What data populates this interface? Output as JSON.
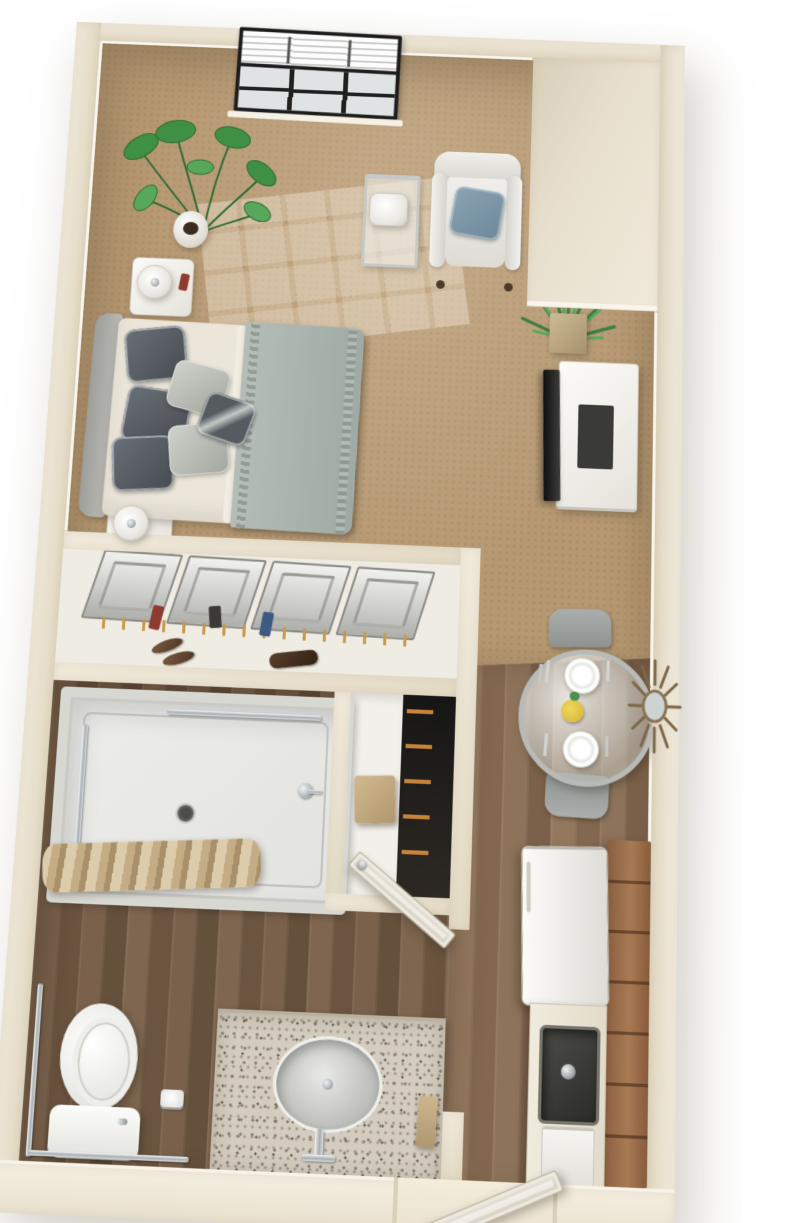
{
  "meta": {
    "title": "Studio apartment 3D floor plan",
    "view": "top-down 3D dollhouse render",
    "description": "3D top-down floor plan rendering of a furnished studio apartment with a bedroom and living area, closet, bathroom, dining nook and kitchenette"
  },
  "palette": {
    "background": "#ffffff",
    "wall": "#ece4d3",
    "wall_shadow": "#d9d0bb",
    "baseboard": "#f9f5ec",
    "carpet": "#b69872",
    "wood_living": "#8b7158",
    "wood_bathroom": "#77604b",
    "shower_base": "#e9e9e6",
    "granite": "#cbc4b7",
    "cabinet_brown": "#9c6f4c",
    "appliance_white": "#f4f3ef",
    "bedding_gray": "#aab3ad",
    "sheet_ivory": "#ece6da",
    "pillow_dark": "#565b61",
    "pillow_blue": "#7e98a8",
    "chair_gray": "#9ba09e",
    "plant_green": "#4c9152",
    "chrome": "#c3c6c8",
    "tv_black": "#222222",
    "door_white": "#f5f2ea",
    "towel_tan": "#c2a67c",
    "curtain_tan": "#c4ae88"
  },
  "rooms": [
    {
      "id": "bedroom-living",
      "label": "Bedroom / living area",
      "flooring": "carpet"
    },
    {
      "id": "closet",
      "label": "Closet",
      "flooring": "carpet"
    },
    {
      "id": "bathroom",
      "label": "Bathroom",
      "flooring": "wood plank"
    },
    {
      "id": "dining-kitchen",
      "label": "Dining nook / kitchenette hall",
      "flooring": "wood plank"
    }
  ],
  "furniture": {
    "bedroom_living": [
      "window with venetian blinds",
      "monstera floor plant in white pot",
      "bed with ivory sheets and gray comforter",
      "upholstered gray headboard",
      "dark gray and light gray accent pillows",
      "white nightstand with table lamp (head of bed)",
      "white nightstand with table lamp (foot of bed)",
      "chrome etagere side table with white lamp",
      "white armchair with blue accent pillow",
      "yucca plant in square planter",
      "white TV console",
      "flat-screen TV"
    ],
    "closet": [
      "sliding panel closet doors",
      "clothes on gold hangers",
      "two pairs of shoes",
      "dark handbag"
    ],
    "bathroom": [
      "walk-in shower with chrome grab bars",
      "shower head",
      "tan shower curtain",
      "floor drain",
      "linen closet with shelves and tan towel",
      "toilet",
      "L-shaped chrome grab bar",
      "toilet paper holder",
      "granite vanity with round sink",
      "chrome faucet",
      "tan hand towel",
      "white bathroom door shown open"
    ],
    "dining_kitchen": [
      "round glass dining table",
      "two gray upholstered dining chairs",
      "two white place settings with cutlery",
      "yellow floral centerpiece",
      "bronze sunburst wall mirror",
      "white refrigerator",
      "kitchen counter",
      "dark undermount sink with faucet",
      "tall brown cabinet run",
      "white under-counter appliance",
      "white entry door shown open"
    ]
  }
}
